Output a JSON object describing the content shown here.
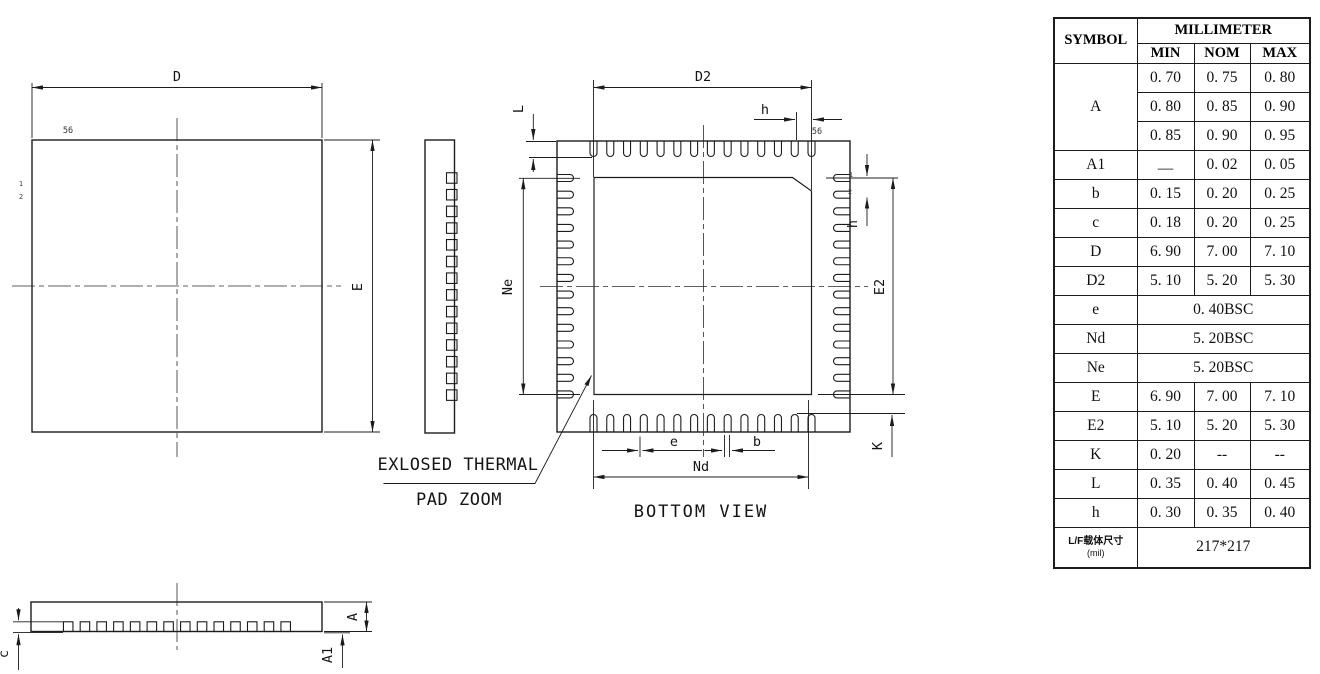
{
  "drawing": {
    "top_view": {
      "dim_d": "D",
      "dim_e": "E",
      "pin56": "56",
      "pin1": "1",
      "pin2": "2"
    },
    "bottom_view": {
      "dim_d2": "D2",
      "dim_h_top": "h",
      "dim_l": "L",
      "dim_ne": "Ne",
      "dim_e2": "E2",
      "dim_h_right": "h",
      "dim_k": "K",
      "dim_e": "e",
      "dim_b": "b",
      "dim_nd": "Nd",
      "pin56": "56",
      "pin1": "1",
      "pin2": "2",
      "caption": "BOTTOM VIEW"
    },
    "profile_view": {
      "dim_a": "A",
      "dim_a1": "A1",
      "dim_c": "c"
    },
    "callout": {
      "line1": "EXLOSED THERMAL",
      "line2": "PAD ZOOM"
    }
  },
  "table": {
    "header": {
      "symbol": "SYMBOL",
      "unit": "MILLIMETER",
      "columns": [
        "MIN",
        "NOM",
        "MAX"
      ]
    },
    "rows": [
      {
        "symbol": "A",
        "values": [
          [
            "0. 70",
            "0. 75",
            "0. 80"
          ],
          [
            "0. 80",
            "0. 85",
            "0. 90"
          ],
          [
            "0. 85",
            "0. 90",
            "0. 95"
          ]
        ]
      },
      {
        "symbol": "A1",
        "values": [
          "—",
          "0. 02",
          "0. 05"
        ]
      },
      {
        "symbol": "b",
        "values": [
          "0. 15",
          "0. 20",
          "0. 25"
        ]
      },
      {
        "symbol": "c",
        "values": [
          "0. 18",
          "0. 20",
          "0. 25"
        ]
      },
      {
        "symbol": "D",
        "values": [
          "6. 90",
          "7. 00",
          "7. 10"
        ]
      },
      {
        "symbol": "D2",
        "values": [
          "5. 10",
          "5. 20",
          "5. 30"
        ]
      },
      {
        "symbol": "e",
        "merged": "0. 40BSC"
      },
      {
        "symbol": "Nd",
        "merged": "5. 20BSC"
      },
      {
        "symbol": "Ne",
        "merged": "5. 20BSC"
      },
      {
        "symbol": "E",
        "values": [
          "6. 90",
          "7. 00",
          "7. 10"
        ]
      },
      {
        "symbol": "E2",
        "values": [
          "5. 10",
          "5. 20",
          "5. 30"
        ]
      },
      {
        "symbol": "K",
        "values": [
          "0. 20",
          "--",
          "--"
        ]
      },
      {
        "symbol": "L",
        "values": [
          "0. 35",
          "0. 40",
          "0. 45"
        ]
      },
      {
        "symbol": "h",
        "values": [
          "0. 30",
          "0. 35",
          "0. 40"
        ]
      },
      {
        "symbol": "L/F载体尺寸",
        "symbol_sub": "(mil)",
        "merged": "217*217"
      }
    ]
  },
  "colors": {
    "line": "#1c1c1c",
    "text": "#141414",
    "background": "#ffffff"
  }
}
